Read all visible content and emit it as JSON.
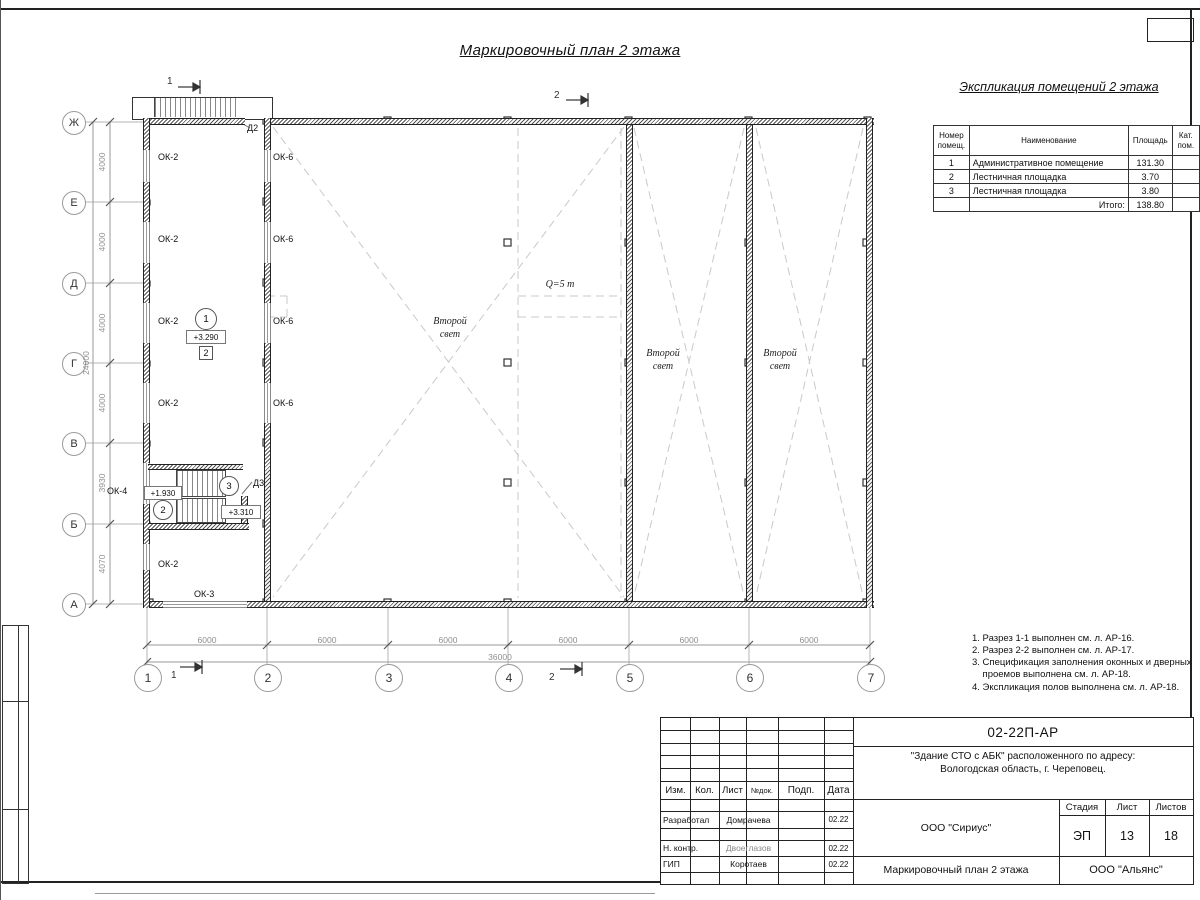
{
  "sheet": {
    "title": "Маркировочный план 2 этажа"
  },
  "legend": {
    "title": "Экспликация помещений 2 этажа",
    "headers": [
      "Номер\nпомещ.",
      "Наименование",
      "Площадь",
      "Кат.\nпом."
    ],
    "rows": [
      [
        "1",
        "Административное помещение",
        "131.30",
        ""
      ],
      [
        "2",
        "Лестничная площадка",
        "3.70",
        ""
      ],
      [
        "3",
        "Лестничная площадка",
        "3.80",
        ""
      ]
    ],
    "total_label": "Итого:",
    "total_value": "138.80"
  },
  "notes": [
    "1. Разрез 1-1 выполнен см. л. АР-16.",
    "2. Разрез 2-2 выполнен см. л. АР-17.",
    "3. Спецификация заполнения оконных и дверных\n    проемов выполнена см. л. АР-18.",
    "4. Экспликация полов выполнена см. л. АР-18."
  ],
  "plan": {
    "axes_rows": [
      "Ж",
      "Е",
      "Д",
      "Г",
      "В",
      "Б",
      "А"
    ],
    "axes_cols": [
      "1",
      "2",
      "3",
      "4",
      "5",
      "6",
      "7"
    ],
    "dims_v": [
      "4000",
      "4000",
      "4000",
      "4000",
      "3930",
      "4070"
    ],
    "dim_v_total": "24000",
    "dims_h": [
      "6000",
      "6000",
      "6000",
      "6000",
      "6000",
      "6000"
    ],
    "dim_h_total": "36000",
    "labels": {
      "ok2": "ОК-2",
      "ok3": "ОК-3",
      "ok4": "ОК-4",
      "ok6": "ОК-6",
      "d2": "Д2",
      "d3": "Д3",
      "second_light": "Второй\nсвет",
      "crane": "Q=5 т"
    },
    "marks": {
      "room1": "1",
      "room2": "2",
      "room3": "3",
      "floor_type": "2",
      "elev_room": "+3.290",
      "elev_mid": "+1.930",
      "elev_top": "+3.310"
    },
    "sections": {
      "s1": "1",
      "s2": "2"
    }
  },
  "title_block": {
    "doc_number": "02-22П-АР",
    "project_line1": "\"Здание СТО с АБК\" расположенного по адресу:",
    "project_line2": "Вологодская область, г. Череповец.",
    "org": "ООО \"Сириус\"",
    "org2": "ООО \"Альянс\"",
    "drawing_title": "Маркировочный план 2 этажа",
    "cols": [
      "Изм.",
      "Кол.",
      "Лист",
      "№док.",
      "Подп.",
      "Дата"
    ],
    "stage_label": "Стадия",
    "sheet_label": "Лист",
    "sheets_label": "Листов",
    "stage": "ЭП",
    "sheet_no": "13",
    "sheets_total": "18",
    "rows": [
      {
        "role": "Разработал",
        "name": "Домрачева",
        "date": "02.22"
      },
      {
        "role": "Н. контр.",
        "name": "Двоеглазов",
        "date": "02.22"
      },
      {
        "role": "ГИП",
        "name": "Коротаев",
        "date": "02.22"
      }
    ]
  }
}
